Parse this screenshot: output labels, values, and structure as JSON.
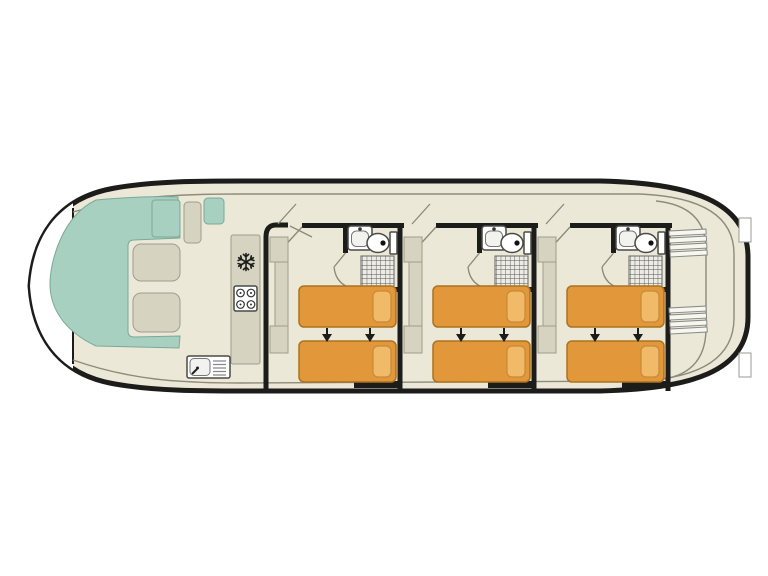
{
  "page": {
    "background": "#ffffff"
  },
  "diagram": {
    "type": "houseboat-deck-plan",
    "colors": {
      "page": "#ffffff",
      "cream": "#ebe8d7",
      "white": "#ffffff",
      "wall": "#1c1c1a",
      "thin": "#8e8b7c",
      "teal": "#a7d0c1",
      "tealStroke": "#7aa998",
      "beige": "#d7d3c1",
      "beigeStroke": "#a19d8b",
      "bed": "#e2973a",
      "bedStroke": "#aa731f",
      "pillow": "#f0ba68",
      "pillowStroke": "#c68a38",
      "fixtureStroke": "#4a4a46"
    },
    "bow": {
      "open_deck": true,
      "windshield": true
    },
    "saloon": {
      "dinette": "u-shaped-bench",
      "tables": 2,
      "side_benches": 2,
      "helm_seat": 1
    },
    "galley": {
      "appliances": [
        "fridge-freezer",
        "stove",
        "sink-with-drainer"
      ],
      "burners": 4
    },
    "cabins": [
      {
        "x": 266
      },
      {
        "x": 400
      },
      {
        "x": 534
      }
    ],
    "cabin_features": {
      "beds_per_cabin": 2,
      "bed_join_arrows": 2,
      "wardrobe": true,
      "bathroom": [
        "washbasin",
        "toilet",
        "shower"
      ]
    },
    "stairs": [
      {
        "x": 669,
        "y": 231
      },
      {
        "x": 669,
        "y": 308
      }
    ],
    "stern_steps": [
      {
        "x": 739,
        "y": 218
      },
      {
        "x": 739,
        "y": 353
      }
    ]
  }
}
